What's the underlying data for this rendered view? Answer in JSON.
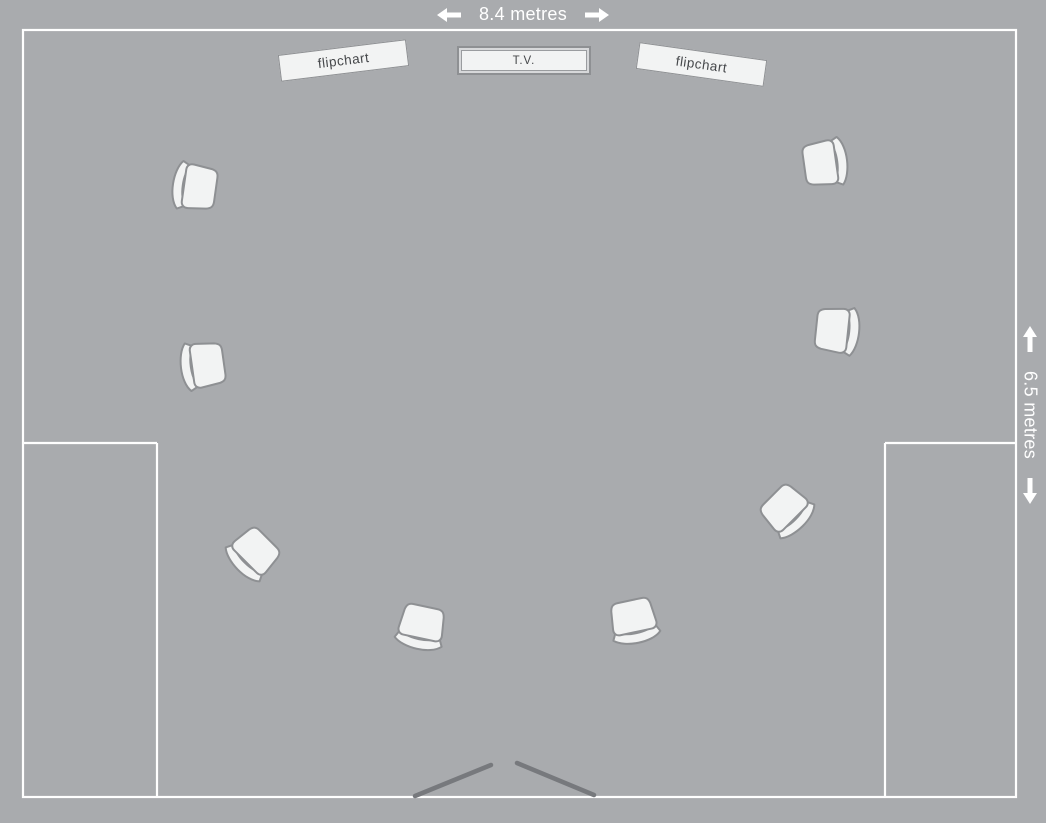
{
  "colors": {
    "background": "#a9abae",
    "wall": "#ffffff",
    "furniture_fill": "#f2f3f3",
    "furniture_stroke": "#8e9093",
    "door": "#77797d",
    "label_text": "#45474a",
    "dimension_text": "#ffffff"
  },
  "dimensions": {
    "width": {
      "label": "8.4 metres"
    },
    "height": {
      "label": "6.5 metres"
    }
  },
  "furniture": {
    "flipchart_left": "flipchart",
    "tv": "T.V.",
    "flipchart_right": "flipchart"
  },
  "floorplan": {
    "room": {
      "left": 23,
      "top": 30,
      "right": 1016,
      "bottom": 797
    },
    "alcove_walls": [
      [
        23,
        443,
        157,
        443
      ],
      [
        157,
        443,
        157,
        797
      ],
      [
        885,
        443,
        1016,
        443
      ],
      [
        885,
        443,
        885,
        797
      ]
    ],
    "door_lines": [
      [
        415,
        796,
        491,
        765
      ],
      [
        517,
        763,
        594,
        795
      ]
    ],
    "chairs": [
      {
        "x": 189,
        "y": 186,
        "rotation": 8
      },
      {
        "x": 197,
        "y": 366,
        "rotation": -8
      },
      {
        "x": 249,
        "y": 558,
        "rotation": -45
      },
      {
        "x": 420,
        "y": 633,
        "rotation": -78
      },
      {
        "x": 635,
        "y": 627,
        "rotation": -102
      },
      {
        "x": 791,
        "y": 515,
        "rotation": -135
      },
      {
        "x": 843,
        "y": 331,
        "rotation": 186
      },
      {
        "x": 831,
        "y": 162,
        "rotation": 172
      }
    ]
  }
}
